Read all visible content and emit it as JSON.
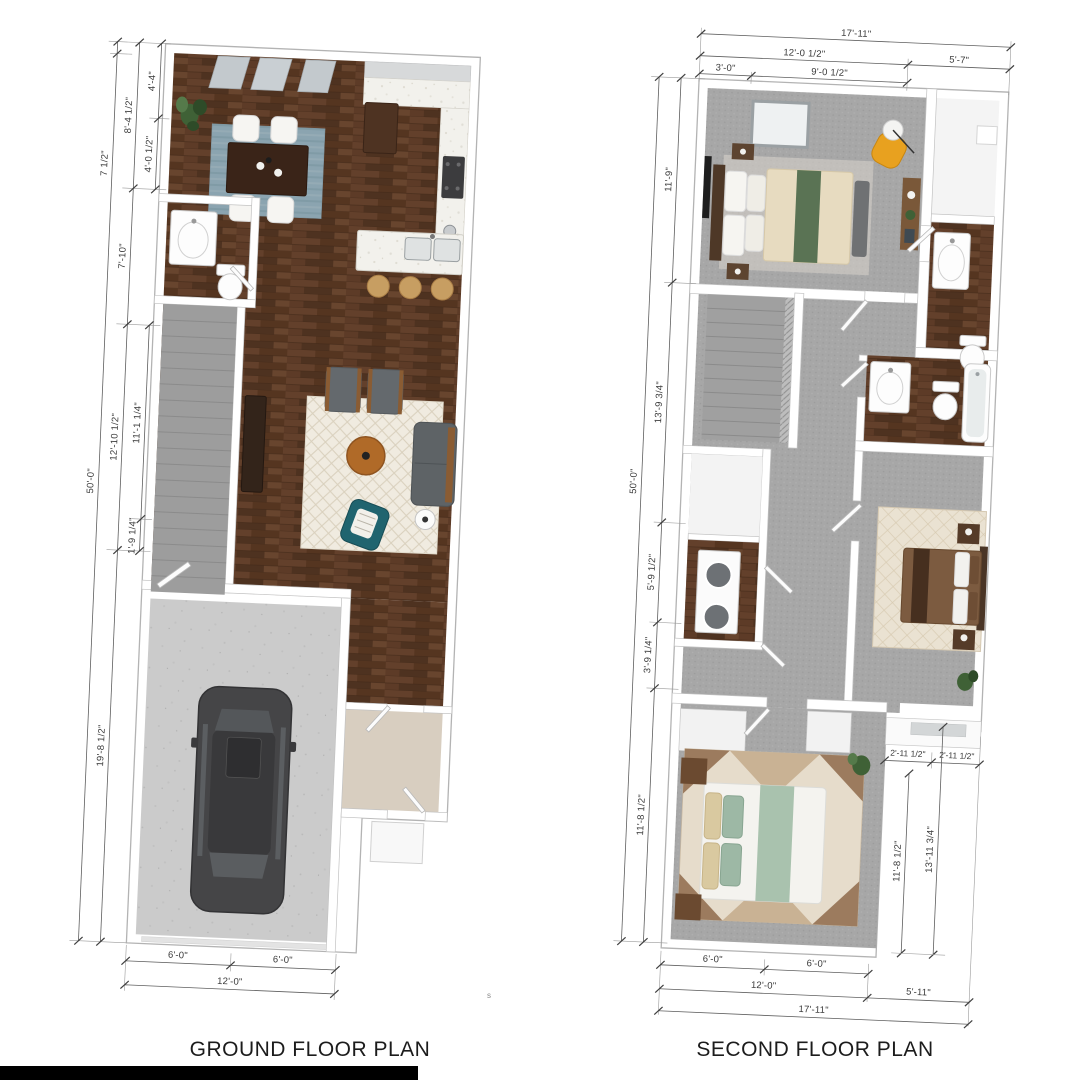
{
  "ground_floor": {
    "title": "GROUND FLOOR PLAN",
    "stray_mark": "s",
    "dims": {
      "left_outer": [
        "7 1/2\"",
        "50'-0\""
      ],
      "left_mid": [
        "8'-4 1/2\"",
        "7'-10\"",
        "12'-10 1/2\"",
        "19'-8 1/2\""
      ],
      "left_inner": [
        "4'-4\"",
        "4'-0 1/2\"",
        "11'-1 1/4\"",
        "1'-9 1/4\""
      ],
      "bottom_inner": [
        "6'-0\"",
        "6'-0\""
      ],
      "bottom_outer": [
        "12'-0\""
      ]
    }
  },
  "second_floor": {
    "title": "SECOND FLOOR PLAN",
    "dims": {
      "top_outer": [
        "17'-11\""
      ],
      "top_mid": [
        "12'-0 1/2\"",
        "5'-7\""
      ],
      "top_inner": [
        "3'-0\"",
        "9'-0 1/2\""
      ],
      "left_outer": [
        "50'-0\""
      ],
      "left_inner": [
        "11'-9\"",
        "13'-9 3/4\"",
        "5'-9 1/2\"",
        "3'-9 1/4\"",
        "11'-8 1/2\""
      ],
      "right_horizontal": [
        "2'-11 1/2\"",
        "2'-11 1/2\""
      ],
      "right_vertical": [
        "11'-8 1/2\"",
        "13'-11 3/4\""
      ],
      "bottom_inner": [
        "6'-0\"",
        "6'-0\""
      ],
      "bottom_mid": [
        "12'-0\"",
        "5'-11\""
      ],
      "bottom_outer": [
        "17'-11\""
      ]
    }
  },
  "colors": {
    "hardwood": "#5a3926",
    "carpet": "#a7a7a7",
    "concrete": "#cbcbcb",
    "entry_tile": "#d8cec0",
    "marble_counter": "#f2f1ec",
    "dining_rug": "#8ba4b0",
    "accent_chair_teal": "#20646f",
    "coffee_table_orange": "#b06a28",
    "stool_tan": "#c79e62",
    "desk_chair_yellow": "#e8a11f",
    "bed_green_runner": "#5a7354",
    "bed_sage": "#a9c2ae",
    "bed_brown": "#7c5b40",
    "car_body": "#454547",
    "plant_green": "#3f6136",
    "dimension_text": "#3a3a3a"
  }
}
